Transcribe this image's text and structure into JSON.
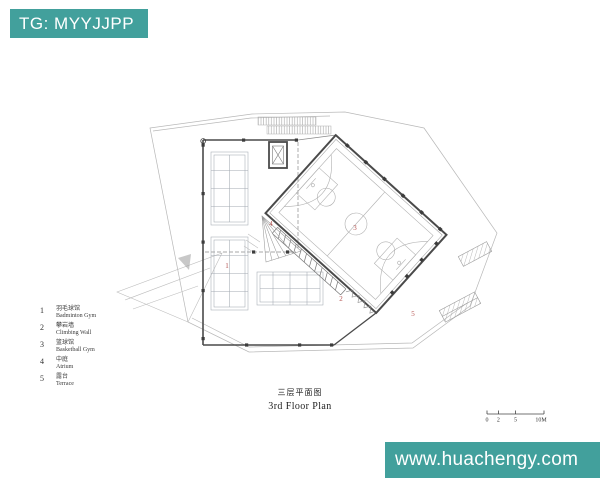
{
  "banners": {
    "top_left": {
      "text": "TG: MYYJJPP"
    },
    "bottom_right": {
      "text": "www.huachengy.com"
    },
    "background_color": "#42a09c",
    "text_color": "#ffffff"
  },
  "legend": {
    "items": [
      {
        "num": "1",
        "zh": "羽毛球馆",
        "en": "Badminton Gym"
      },
      {
        "num": "2",
        "zh": "攀岩墙",
        "en": "Climbing Wall"
      },
      {
        "num": "3",
        "zh": "篮球馆",
        "en": "Basketball Gym"
      },
      {
        "num": "4",
        "zh": "中庭",
        "en": "Atrium"
      },
      {
        "num": "5",
        "zh": "露台",
        "en": "Terrace"
      }
    ]
  },
  "title": {
    "zh": "三层平面图",
    "en": "3rd Floor Plan"
  },
  "scale_bar": {
    "labels": [
      "0",
      "2",
      "5",
      "10M"
    ]
  },
  "plan": {
    "room_label_color": "#b4524f",
    "wall_color": "#4a4a4a",
    "line_color": "#b8b8b8"
  }
}
